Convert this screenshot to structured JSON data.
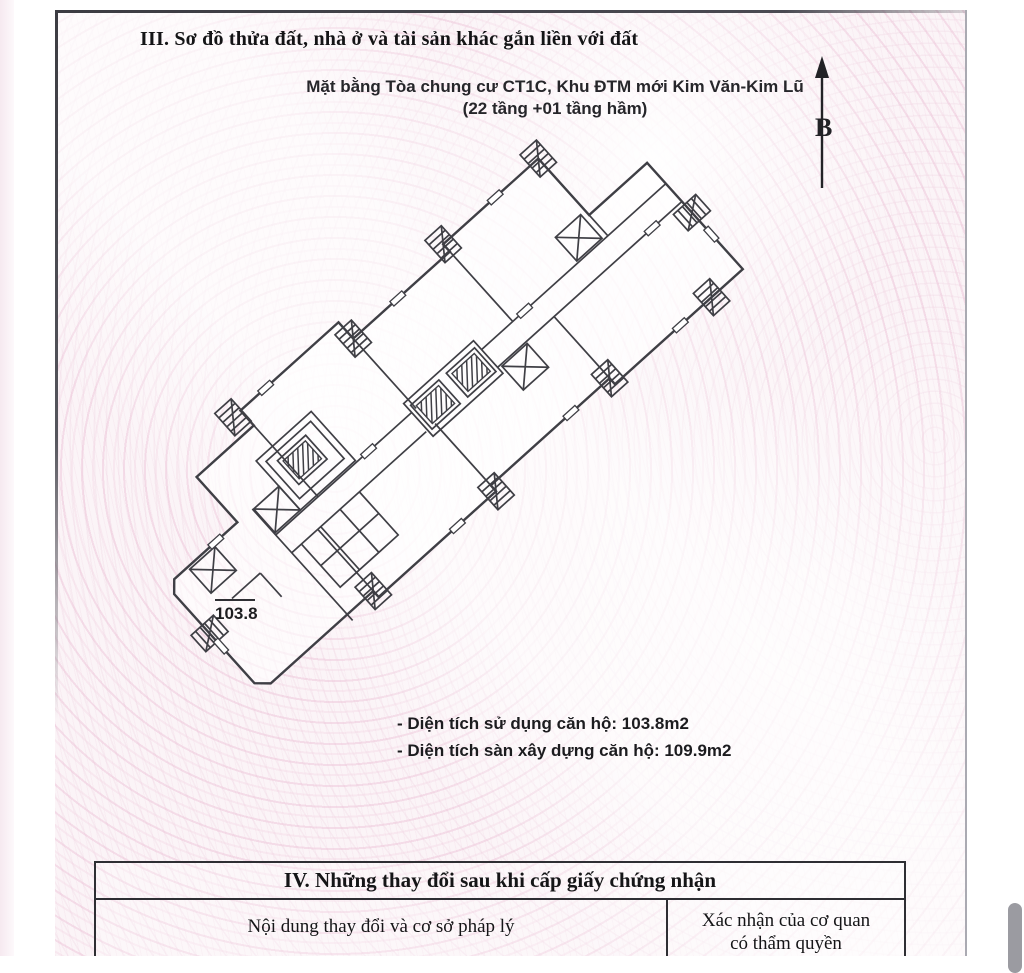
{
  "doc": {
    "section3": {
      "title": "III. Sơ đồ thửa đất, nhà ở và tài sản khác gắn liền với đất"
    },
    "plan": {
      "caption_line1": "Mặt bằng Tòa chung cư CT1C, Khu ĐTM mới Kim Văn-Kim Lũ",
      "caption_line2": "(22 tầng +01 tầng hầm)",
      "north_label": "B",
      "unit_area": "103.8",
      "notes": [
        "- Diện tích sử dụng căn hộ: 103.8m2",
        "- Diện tích sàn xây dựng căn hộ: 109.9m2"
      ]
    },
    "section4": {
      "title": "IV. Những thay đổi sau khi cấp giấy chứng nhận",
      "col1_header": "Nội dung thay đổi và cơ sở pháp lý",
      "col2_header_line1": "Xác nhận của cơ quan",
      "col2_header_line2": "có thẩm quyền"
    },
    "colors": {
      "pattern_pink": "#f2d8e4",
      "line_dark": "#3f3f45"
    }
  }
}
